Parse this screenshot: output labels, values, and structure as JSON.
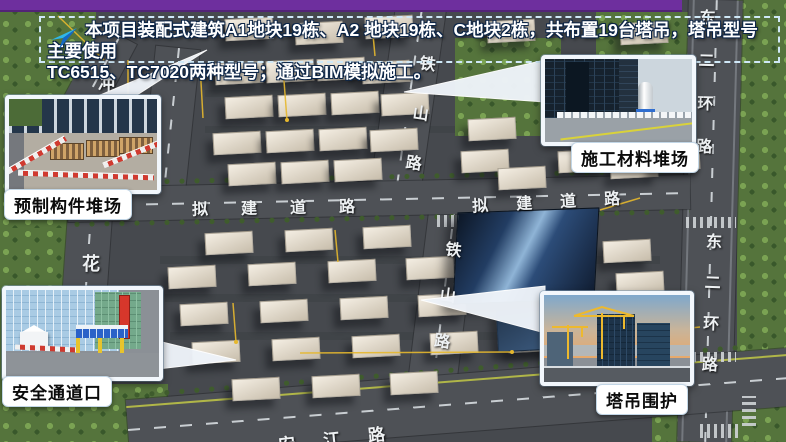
{
  "banner": {
    "line1": "本项目装配式建筑A1地块19栋、A2 地块19栋、C地块2栋，共布置19台塔吊，塔吊型号主要使用",
    "line2": "TC6515、TC7020两种型号；通过BIM模拟施工。",
    "icon": "send-arrow-icon",
    "border_color": "#cfe8f7",
    "text_color": "#ffffff"
  },
  "top_bar": {
    "color": "#6e2f9e"
  },
  "callouts": {
    "precast_yard": {
      "label": "预制构件堆场"
    },
    "material_yard": {
      "label": "施工材料堆场"
    },
    "safety_passage": {
      "label": "安全通道口"
    },
    "crane_enclosure": {
      "label": "塔吊围护"
    }
  },
  "roads": {
    "tieshan_upper": {
      "name": "铁山路",
      "chars": [
        "铁",
        "山",
        "路"
      ]
    },
    "tieshan_lower": {
      "name": "铁山路",
      "chars": [
        "铁",
        "山",
        "路"
      ]
    },
    "proposed_left": {
      "name": "拟建道路",
      "chars": [
        "拟",
        "建",
        "道",
        "路"
      ]
    },
    "proposed_right": {
      "name": "拟建道路",
      "chars": [
        "拟",
        "建",
        "道",
        "路"
      ]
    },
    "east2ring_upper": {
      "name": "东二环路",
      "chars": [
        "东",
        "二",
        "环",
        "路"
      ]
    },
    "east2ring_lower": {
      "name": "东二环路",
      "chars": [
        "东",
        "二",
        "环",
        "路"
      ]
    },
    "hua": {
      "name": "花",
      "chars": [
        "花"
      ]
    },
    "chong": {
      "name": "冲",
      "chars": [
        "冲"
      ]
    },
    "anjiang": {
      "name": "安江路",
      "chars": [
        "安",
        "江",
        "路"
      ]
    }
  }
}
